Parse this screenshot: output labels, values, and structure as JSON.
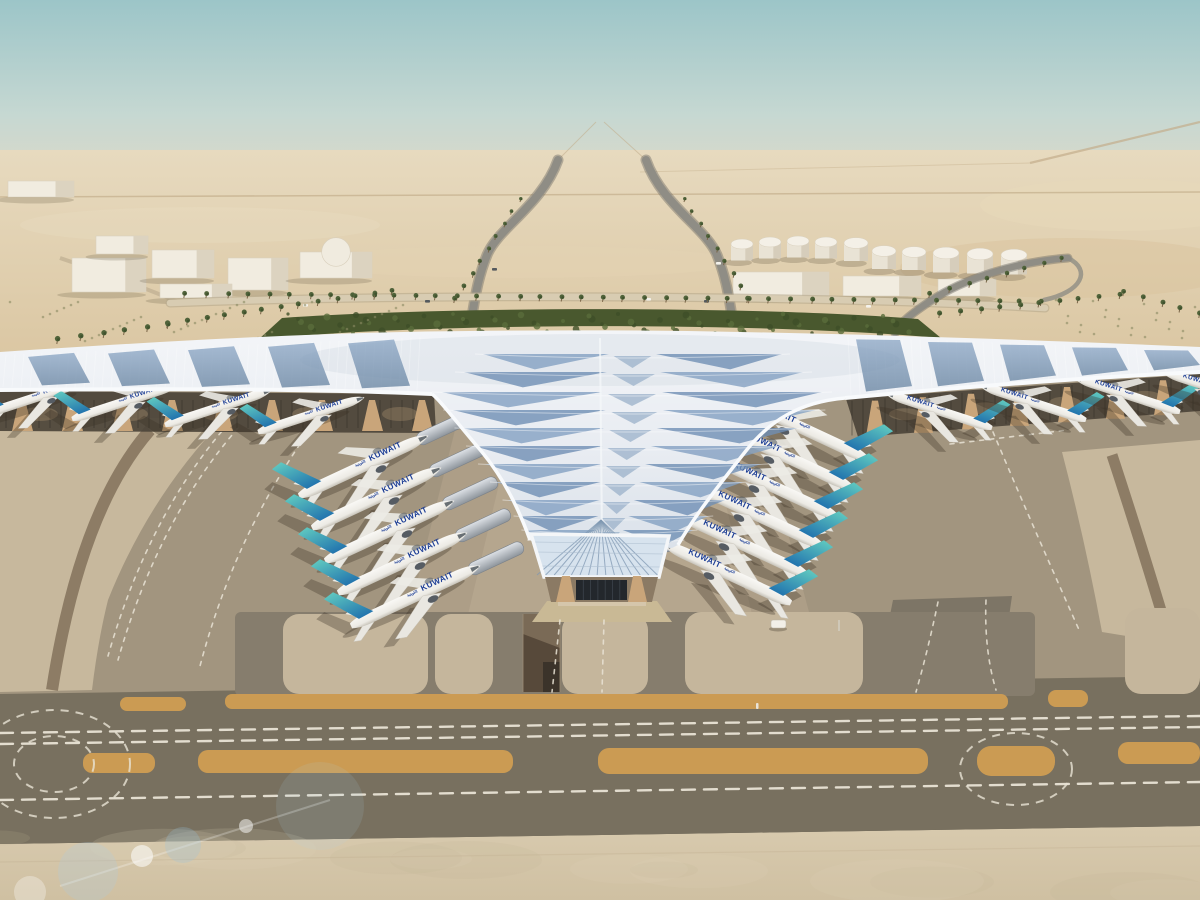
{
  "meta": {
    "subject": "Aerial architectural rendering of Kuwait International Airport Terminal 2: swooping white trefoil roof with blue photovoltaic panels, Kuwait Airways jets parked at both flanks, desert landscape with palm-lined approach roads, fuel tanks and taxiways with orange shoulder strips",
    "time_of_day": "day"
  },
  "airline": {
    "label": "KUWAIT",
    "label_arabic": "الكويتية"
  },
  "counts": {
    "total_aircraft": 19,
    "left_column": 5,
    "right_column": 6,
    "left_pier": 4,
    "right_pier": 4,
    "fuel_tanks": 10
  },
  "colors": {
    "sky_top": "#9cc5c8",
    "sky_mid": "#c6d8d2",
    "haze": "#e6dac3",
    "desert_far": "#e7dabf",
    "desert_mid": "#dbc7a3",
    "greenery": "#49582e",
    "palm_crown": "#50633a",
    "palm_trunk": "#7a6548",
    "roof_light": "#f3f5f8",
    "roof_shade": "#dbe2ea",
    "pv_light": "#8aa5c4",
    "pv_dark": "#64819f",
    "fascia": "#f8fafc",
    "canopy_shadow": "#4c443a",
    "arch_tan": "#c9a57a",
    "apron": "#a2957f",
    "apron_light": "#c7b89d",
    "taxiway_dark": "#78705f",
    "taxi_brown": "#8d7c65",
    "concrete_fg": "#d4c6ab",
    "marking": "#e9e3d5",
    "strip_orange": "#d09d52",
    "fuselage": "#f6f5f1",
    "tail_teal": "#5fc8c0",
    "tail_blue": "#2274ae",
    "title_blue": "#1e3f96",
    "shadow": "rgba(56,46,34,0.32)"
  },
  "aircraft": {
    "left_column": {
      "dir": 1,
      "angle": -25,
      "scale": 1.02,
      "pod": true,
      "planes": [
        [
          299,
          496
        ],
        [
          312,
          528
        ],
        [
          325,
          561
        ],
        [
          338,
          593
        ],
        [
          351,
          626
        ]
      ]
    },
    "right_column": {
      "dir": -1,
      "angle": 25,
      "scale": 1.02,
      "pod": true,
      "planes": [
        [
          866,
          458
        ],
        [
          851,
          487
        ],
        [
          836,
          516
        ],
        [
          821,
          545
        ],
        [
          806,
          574
        ],
        [
          791,
          603
        ]
      ]
    },
    "left_pier": {
      "dir": 1,
      "angle": -18,
      "scale": 0.8,
      "pod": false,
      "planes": [
        [
          -15,
          414
        ],
        [
          72,
          419
        ],
        [
          165,
          425
        ],
        [
          258,
          432
        ]
      ]
    },
    "right_pier": {
      "dir": -1,
      "angle": 18,
      "scale": 0.8,
      "pod": false,
      "planes": [
        [
          992,
          428
        ],
        [
          1086,
          420
        ],
        [
          1180,
          412
        ],
        [
          1268,
          406
        ]
      ]
    }
  },
  "ground": {
    "orange_strips": [
      [
        120,
        697,
        66,
        14,
        7
      ],
      [
        225,
        694,
        783,
        15,
        7
      ],
      [
        1048,
        690,
        40,
        17,
        8
      ],
      [
        83,
        753,
        72,
        20,
        9
      ],
      [
        198,
        750,
        315,
        23,
        10
      ],
      [
        598,
        748,
        330,
        26,
        11
      ],
      [
        977,
        746,
        78,
        30,
        14
      ],
      [
        1118,
        742,
        82,
        22,
        10
      ]
    ],
    "stand_pads": [
      [
        283,
        614,
        145,
        80
      ],
      [
        435,
        614,
        58,
        80
      ],
      [
        562,
        614,
        86,
        80
      ],
      [
        685,
        612,
        178,
        82
      ],
      [
        1125,
        608,
        75,
        86
      ]
    ]
  },
  "landside": {
    "fuel_tanks": [
      [
        742,
        244,
        11
      ],
      [
        770,
        242,
        11
      ],
      [
        798,
        241,
        11
      ],
      [
        826,
        242,
        11
      ],
      [
        856,
        243,
        12
      ],
      [
        884,
        251,
        12
      ],
      [
        914,
        252,
        12
      ],
      [
        946,
        253,
        13
      ],
      [
        980,
        254,
        13
      ],
      [
        1014,
        255,
        13
      ]
    ],
    "buildings": [
      [
        8,
        181,
        66,
        16
      ],
      [
        72,
        258,
        74,
        34
      ],
      [
        152,
        250,
        62,
        28
      ],
      [
        96,
        236,
        52,
        18
      ],
      [
        228,
        258,
        60,
        32
      ],
      [
        160,
        284,
        72,
        14
      ],
      [
        300,
        252,
        72,
        26
      ],
      [
        733,
        272,
        96,
        24
      ],
      [
        843,
        276,
        78,
        20
      ],
      [
        938,
        279,
        58,
        17
      ]
    ],
    "dome_index": 6,
    "palm_rows": [
      [
        185,
        298,
        1040,
        306,
        42
      ],
      [
        455,
        303,
        520,
        202,
        9
      ],
      [
        748,
        303,
        684,
        202,
        9
      ],
      [
        168,
        328,
        392,
        295,
        13
      ],
      [
        58,
        344,
        168,
        329,
        6
      ],
      [
        940,
        318,
        1118,
        299,
        10
      ],
      [
        930,
        298,
        1062,
        262,
        8
      ],
      [
        1124,
        296,
        1198,
        318,
        5
      ]
    ],
    "cars": [
      [
        303,
        304
      ],
      [
        425,
        300
      ],
      [
        646,
        298
      ],
      [
        704,
        300
      ],
      [
        866,
        305
      ],
      [
        492,
        268
      ],
      [
        716,
        262
      ]
    ]
  }
}
